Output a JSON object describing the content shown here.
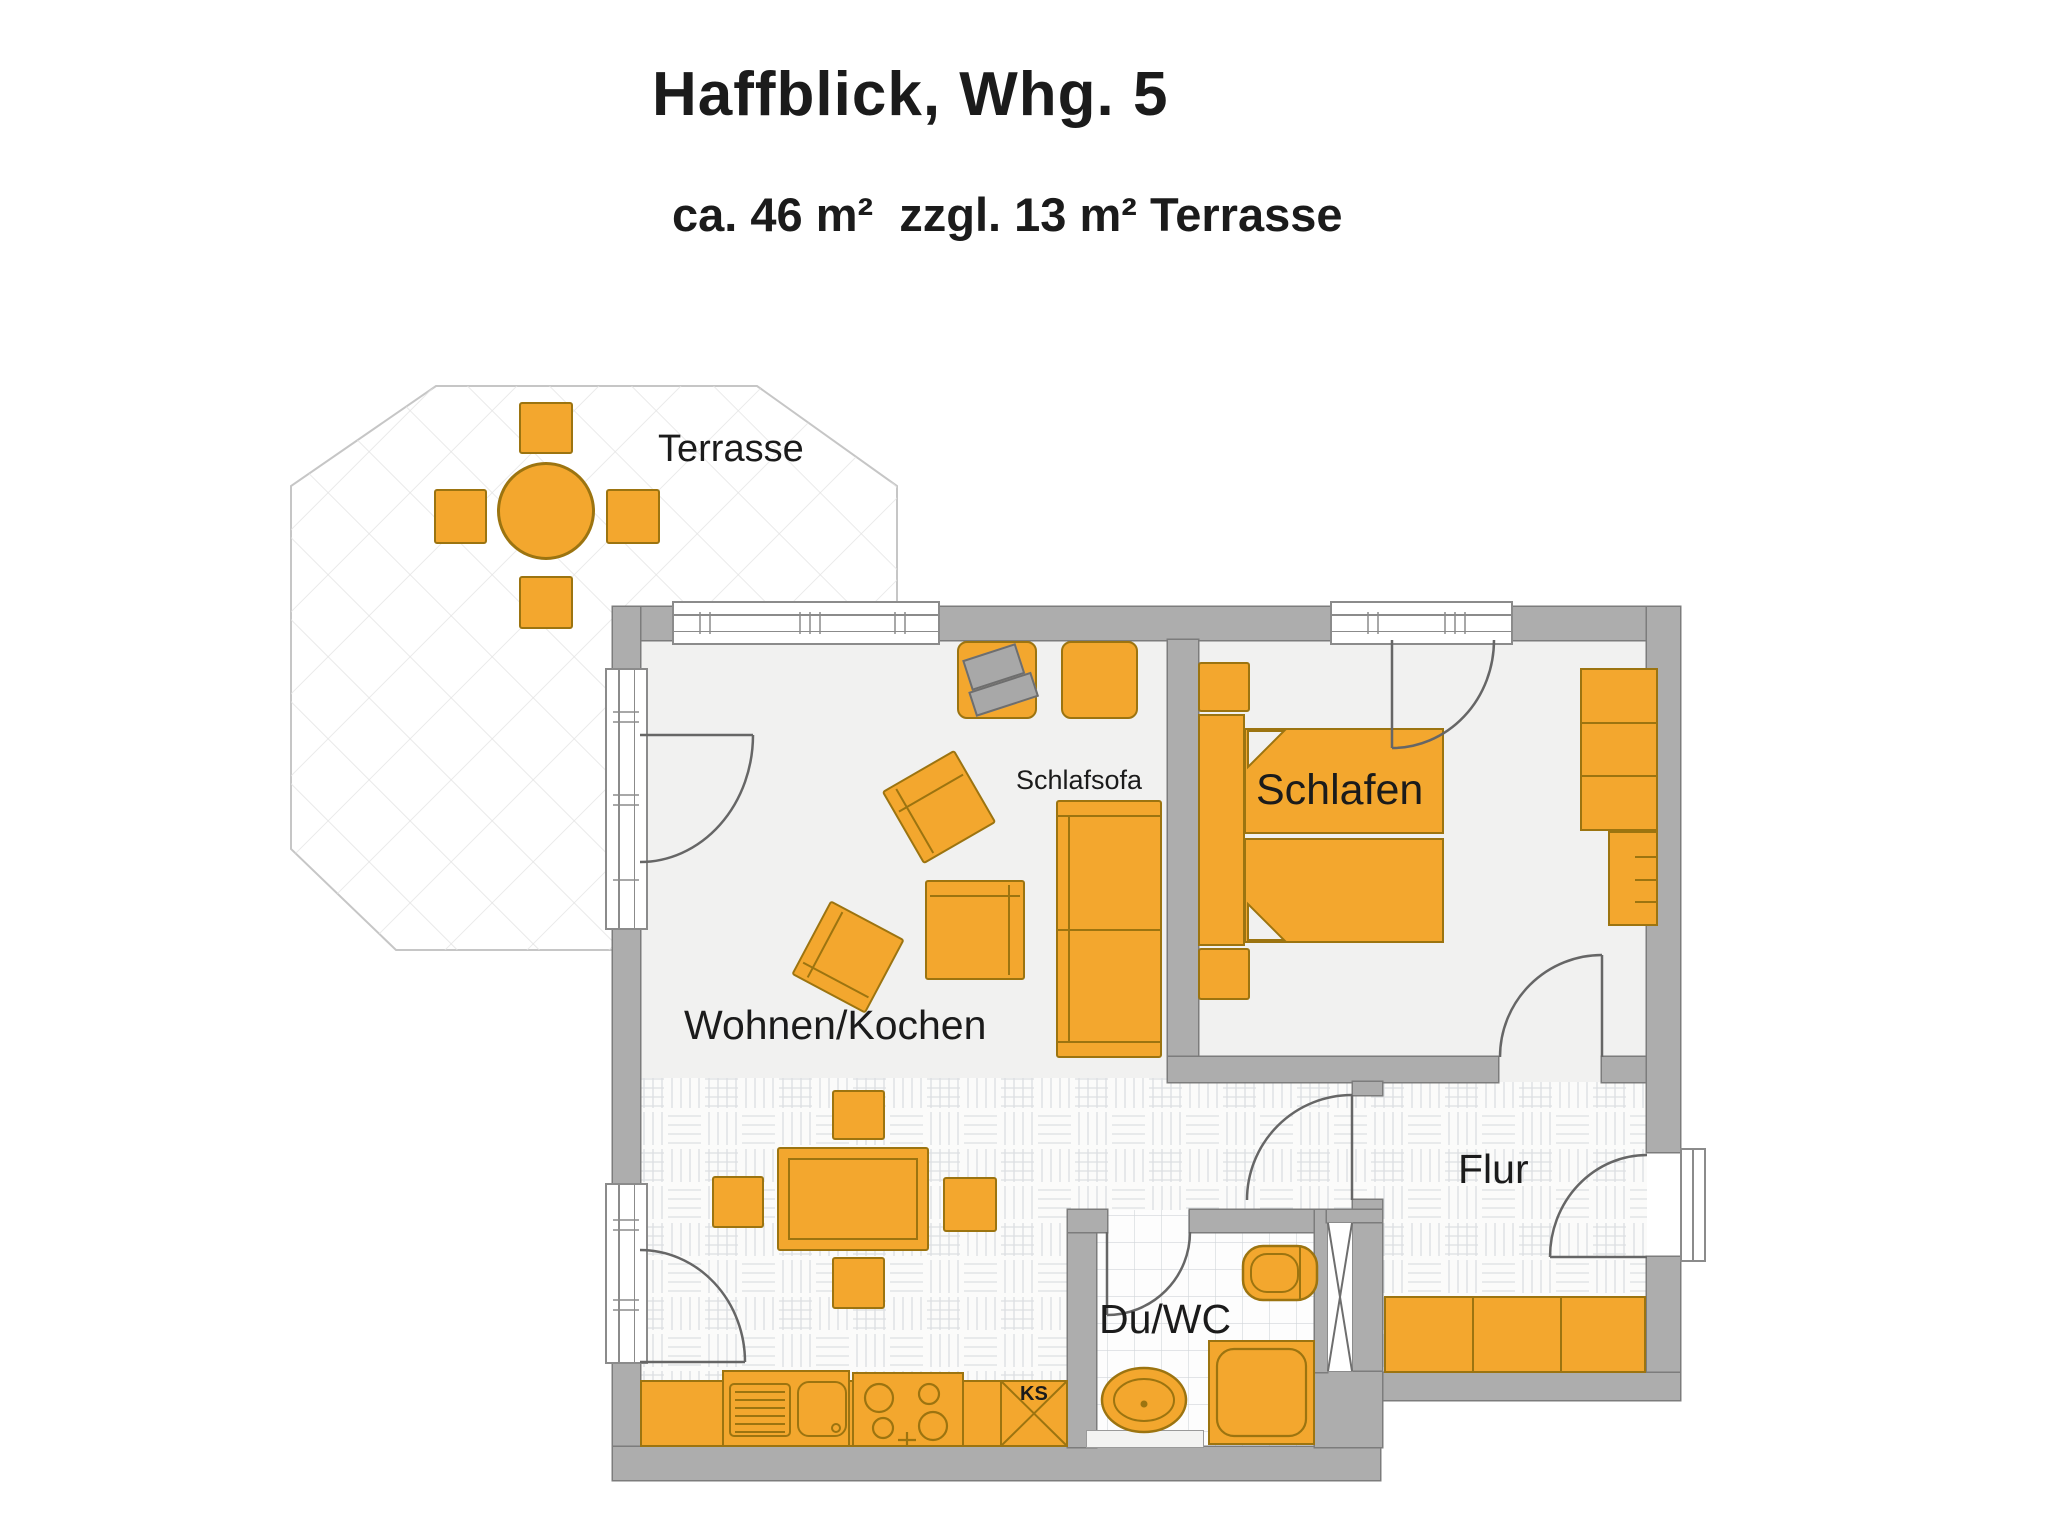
{
  "title": "Haffblick, Whg. 5",
  "subtitle": "ca. 46 m²  zzgl. 13 m² Terrasse",
  "rooms": {
    "terrace": "Terrasse",
    "living_kitchen": "Wohnen/Kochen",
    "bedroom": "Schlafen",
    "hallway": "Flur",
    "bathroom": "Du/WC"
  },
  "furniture_labels": {
    "sleeper_sofa": "Schlafsofa",
    "fridge": "KS"
  },
  "colors": {
    "orange": "#F3A72E",
    "orange-ln": "#9c7410",
    "wall": "#ADADAD",
    "wall-ln": "#7c7c7c",
    "floor": "#F1F1F0",
    "ln": "#666666",
    "tv": "#A8A8A8",
    "tv-ln": "#6e6e6e",
    "txt": "#1b1b1b",
    "parquet-ln": "#dcdfe2",
    "tile-ln": "#d2d6da",
    "hatch-ln": "#e3e3e3"
  }
}
